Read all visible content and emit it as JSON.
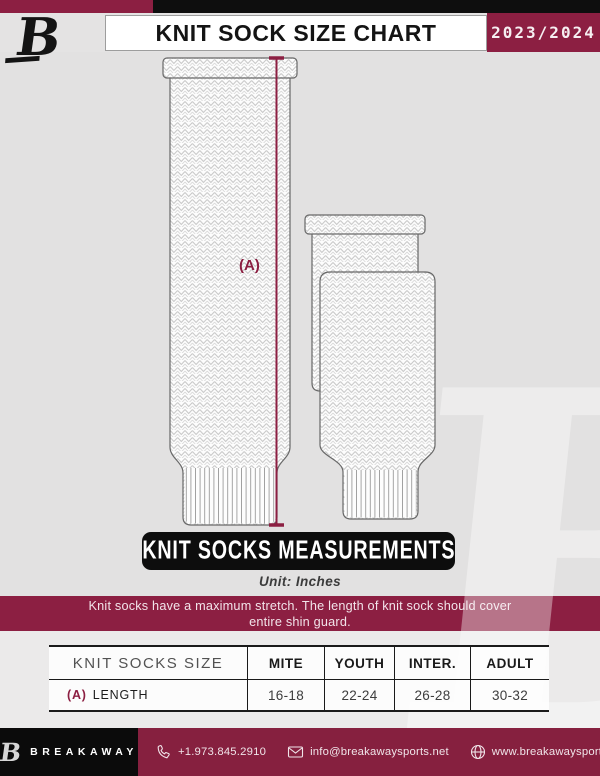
{
  "header": {
    "logo_letter": "B",
    "title": "KNIT SOCK SIZE CHART",
    "season": "2023/2024"
  },
  "diagram": {
    "measurement_label": "(A)"
  },
  "measurements": {
    "banner": "KNIT SOCKS MEASUREMENTS",
    "unit": "Unit: Inches"
  },
  "notice": {
    "line1": "Knit socks have a maximum stretch. The length of knit sock should cover",
    "line2": "entire shin guard."
  },
  "table": {
    "header": [
      "KNIT SOCKS SIZE",
      "MITE",
      "YOUTH",
      "INTER.",
      "ADULT"
    ],
    "rows": [
      {
        "key": "(A)",
        "label": "LENGTH",
        "values": [
          "16-18",
          "22-24",
          "26-28",
          "30-32"
        ]
      }
    ]
  },
  "footer": {
    "logo_letter": "B",
    "brand": "BREAKAWAY",
    "phone": "+1.973.845.2910",
    "email": "info@breakawaysports.net",
    "website": "www.breakawaysports.net"
  },
  "watermark_letter": "B",
  "colors": {
    "maroon": "#8C1F42",
    "black": "#0d0d0d",
    "background_gray": "#e2e1e1"
  }
}
